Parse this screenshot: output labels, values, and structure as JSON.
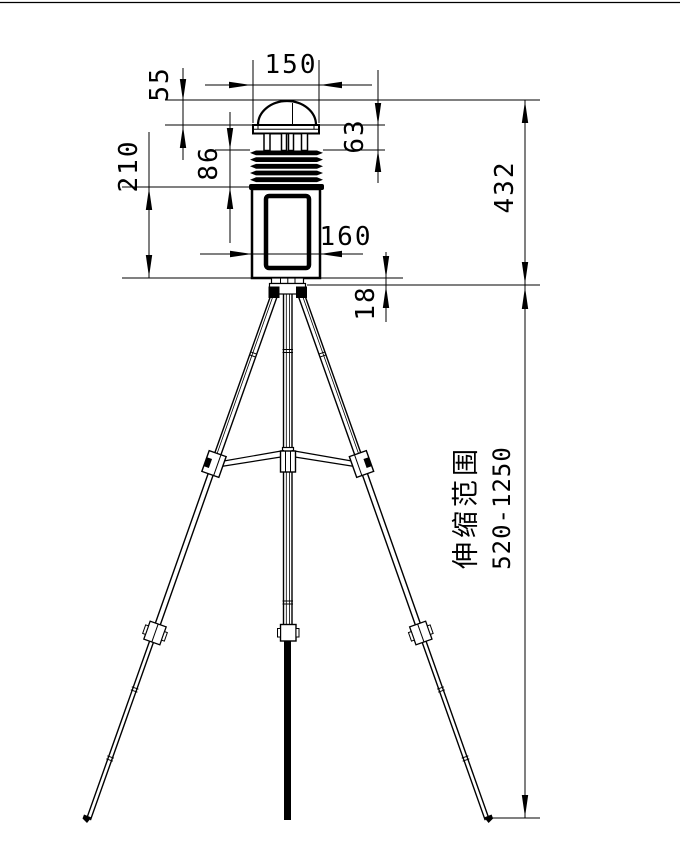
{
  "drawing": {
    "type": "technical-dimension-drawing",
    "subject": "weather-station-on-telescopic-tripod",
    "background_color": "#ffffff",
    "line_color": "#000000",
    "labels": {
      "top_width": "150",
      "dome_height": "55",
      "head_height": "63",
      "shield_height": "86",
      "body_height": "210",
      "body_width": "160",
      "mount_gap": "18",
      "instrument_height": "432",
      "telescopic_caption": "伸缩范围",
      "telescopic_range": "520-1250"
    }
  }
}
